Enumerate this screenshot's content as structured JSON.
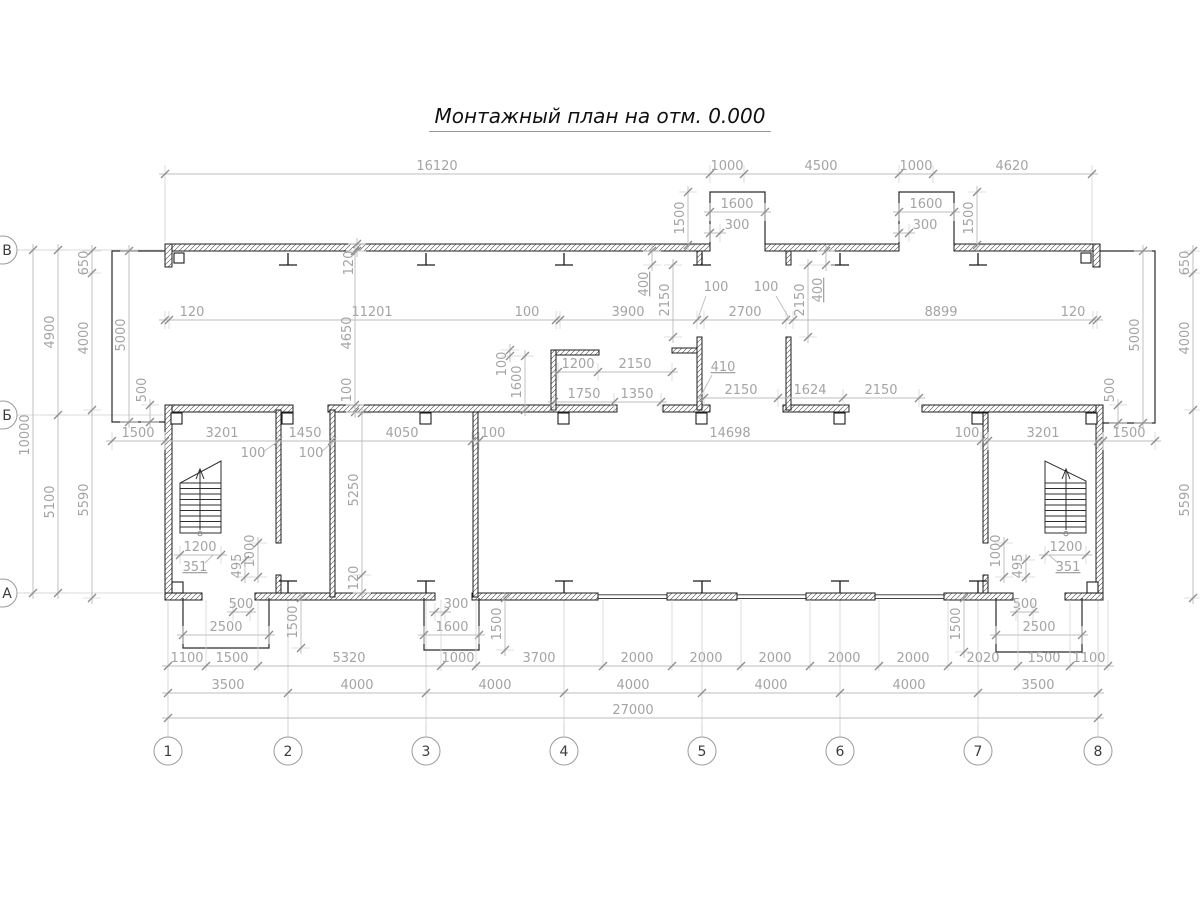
{
  "title": {
    "text": "Монтажный план на отм. 0.000"
  },
  "colors": {
    "wall": "#1c1c1c",
    "dim_line": "#bcbcbc",
    "dim_text": "#a4a4a4",
    "grid_line": "#cfcfcf",
    "bubble_stroke": "#9b9b9b"
  },
  "axis_bubbles": {
    "columns_y": 751,
    "radius": 14,
    "columns": [
      {
        "label": "1",
        "x": 168
      },
      {
        "label": "2",
        "x": 288
      },
      {
        "label": "3",
        "x": 426
      },
      {
        "label": "4",
        "x": 564
      },
      {
        "label": "5",
        "x": 702
      },
      {
        "label": "6",
        "x": 840
      },
      {
        "label": "7",
        "x": 978
      },
      {
        "label": "8",
        "x": 1098
      }
    ],
    "rows_x": 3,
    "rows": [
      {
        "label": "В",
        "y": 250
      },
      {
        "label": "Б",
        "y": 415
      },
      {
        "label": "А",
        "y": 593
      }
    ]
  },
  "dimensions": [
    {
      "dir": "h",
      "at": 174,
      "ticks": [
        165,
        710,
        744,
        899,
        933,
        1092
      ],
      "labels": [
        {
          "t": "16120",
          "c": 437
        },
        {
          "t": "1000",
          "c": 727
        },
        {
          "t": "4500",
          "c": 821
        },
        {
          "t": "1000",
          "c": 916
        },
        {
          "t": "4620",
          "c": 1012
        }
      ]
    },
    {
      "dir": "h",
      "at": 212,
      "ticks": [
        710,
        765
      ],
      "labels": [
        {
          "t": "1600",
          "c": 737
        }
      ]
    },
    {
      "dir": "h",
      "at": 233,
      "ticks": [
        710,
        720
      ],
      "labels": [
        {
          "t": "300",
          "c": 737
        }
      ]
    },
    {
      "dir": "h",
      "at": 212,
      "ticks": [
        899,
        954
      ],
      "labels": [
        {
          "t": "1600",
          "c": 926
        }
      ]
    },
    {
      "dir": "h",
      "at": 233,
      "ticks": [
        899,
        909
      ],
      "labels": [
        {
          "t": "300",
          "c": 925
        }
      ]
    },
    {
      "dir": "h",
      "at": 320,
      "ticks": [
        165,
        169,
        556,
        560,
        697,
        704,
        786,
        793,
        1093,
        1097
      ],
      "labels": [
        {
          "t": "120",
          "c": 192
        },
        {
          "t": "11201",
          "c": 372
        },
        {
          "t": "100",
          "c": 527
        },
        {
          "t": "3900",
          "c": 628
        },
        {
          "t": "2700",
          "c": 745
        },
        {
          "t": "8899",
          "c": 941
        },
        {
          "t": "120",
          "c": 1073
        }
      ]
    },
    {
      "dir": "h",
      "at": 441,
      "ticks": [
        112,
        165,
        278,
        332,
        472,
        479,
        981,
        988,
        1098,
        1103,
        1155
      ],
      "labels": [
        {
          "t": "1500",
          "c": 138
        },
        {
          "t": "3201",
          "c": 222
        },
        {
          "t": "1450",
          "c": 305
        },
        {
          "t": "4050",
          "c": 402
        },
        {
          "t": "100",
          "c": 493
        },
        {
          "t": "14698",
          "c": 730
        },
        {
          "t": "100",
          "c": 967
        },
        {
          "t": "3201",
          "c": 1043
        },
        {
          "t": "1500",
          "c": 1129
        }
      ]
    },
    {
      "dir": "h",
      "at": 372,
      "ticks": [
        558,
        598,
        672
      ],
      "labels": [
        {
          "t": "1200",
          "c": 578
        },
        {
          "t": "2150",
          "c": 635
        }
      ]
    },
    {
      "dir": "h",
      "at": 402,
      "ticks": [
        554,
        614,
        661
      ],
      "labels": [
        {
          "t": "1750",
          "c": 584
        },
        {
          "t": "1350",
          "c": 637
        }
      ]
    },
    {
      "dir": "h",
      "at": 398,
      "ticks": [
        704,
        778,
        843,
        919
      ],
      "labels": [
        {
          "t": "2150",
          "c": 741
        },
        {
          "t": "1624",
          "c": 810
        },
        {
          "t": "2150",
          "c": 881
        }
      ]
    },
    {
      "dir": "h",
      "at": 555,
      "ticks": [
        180,
        221
      ],
      "labels": [
        {
          "t": "1200",
          "c": 200
        }
      ]
    },
    {
      "dir": "h",
      "at": 555,
      "ticks": [
        1045,
        1086
      ],
      "labels": [
        {
          "t": "1200",
          "c": 1066
        }
      ]
    },
    {
      "dir": "h",
      "at": 612,
      "ticks": [
        233,
        250
      ],
      "labels": [
        {
          "t": "500",
          "c": 241
        }
      ]
    },
    {
      "dir": "h",
      "at": 635,
      "ticks": [
        183,
        269
      ],
      "labels": [
        {
          "t": "2500",
          "c": 226
        }
      ]
    },
    {
      "dir": "h",
      "at": 612,
      "ticks": [
        435,
        445
      ],
      "labels": [
        {
          "t": "300",
          "c": 456
        }
      ]
    },
    {
      "dir": "h",
      "at": 635,
      "ticks": [
        424,
        479
      ],
      "labels": [
        {
          "t": "1600",
          "c": 452
        }
      ]
    },
    {
      "dir": "h",
      "at": 612,
      "ticks": [
        1016,
        1033
      ],
      "labels": [
        {
          "t": "500",
          "c": 1025
        }
      ]
    },
    {
      "dir": "h",
      "at": 635,
      "ticks": [
        996,
        1082
      ],
      "labels": [
        {
          "t": "2500",
          "c": 1039
        }
      ]
    },
    {
      "dir": "h",
      "at": 666,
      "eu": 66,
      "ed": 5,
      "ticks": [
        168,
        206,
        258,
        441,
        476,
        603,
        672,
        741,
        810,
        879,
        948,
        1018,
        1070,
        1108
      ],
      "labels": [
        {
          "t": "1100",
          "c": 187
        },
        {
          "t": "1500",
          "c": 232
        },
        {
          "t": "5320",
          "c": 349
        },
        {
          "t": "1000",
          "c": 458
        },
        {
          "t": "3700",
          "c": 539
        },
        {
          "t": "2000",
          "c": 637
        },
        {
          "t": "2000",
          "c": 706
        },
        {
          "t": "2000",
          "c": 775
        },
        {
          "t": "2000",
          "c": 844
        },
        {
          "t": "2000",
          "c": 913
        },
        {
          "t": "2020",
          "c": 983
        },
        {
          "t": "1500",
          "c": 1044
        },
        {
          "t": "1100",
          "c": 1089
        }
      ]
    },
    {
      "dir": "h",
      "at": 693,
      "ticks": [
        168,
        288,
        426,
        564,
        702,
        840,
        978,
        1098
      ],
      "labels": [
        {
          "t": "3500",
          "c": 228
        },
        {
          "t": "4000",
          "c": 357
        },
        {
          "t": "4000",
          "c": 495
        },
        {
          "t": "4000",
          "c": 633
        },
        {
          "t": "4000",
          "c": 771
        },
        {
          "t": "4000",
          "c": 909
        },
        {
          "t": "3500",
          "c": 1038
        }
      ]
    },
    {
      "dir": "h",
      "at": 718,
      "ticks": [
        168,
        1098
      ],
      "labels": [
        {
          "t": "27000",
          "c": 633
        }
      ]
    },
    {
      "dir": "v",
      "at": 688,
      "ticks": [
        192,
        245
      ],
      "labels": [
        {
          "t": "1500",
          "c": 218
        }
      ]
    },
    {
      "dir": "v",
      "at": 977,
      "ticks": [
        192,
        245
      ],
      "labels": [
        {
          "t": "1500",
          "c": 218
        }
      ]
    },
    {
      "dir": "v",
      "at": 33,
      "ticks": [
        250,
        593
      ],
      "labels": [
        {
          "t": "10000",
          "c": 435
        }
      ]
    },
    {
      "dir": "v",
      "at": 58,
      "ticks": [
        250,
        415,
        593
      ],
      "labels": [
        {
          "t": "4900",
          "c": 332
        },
        {
          "t": "5100",
          "c": 502
        }
      ]
    },
    {
      "dir": "v",
      "at": 92,
      "ticks": [
        251,
        273,
        410,
        598
      ],
      "labels": [
        {
          "t": "650",
          "c": 263
        },
        {
          "t": "4000",
          "c": 338
        },
        {
          "t": "5590",
          "c": 500
        }
      ]
    },
    {
      "dir": "v",
      "at": 129,
      "ticks": [
        251,
        422
      ],
      "labels": [
        {
          "t": "5000",
          "c": 335
        }
      ]
    },
    {
      "dir": "v",
      "at": 150,
      "ticks": [
        405,
        422
      ],
      "labels": [
        {
          "t": "500",
          "c": 390
        }
      ]
    },
    {
      "dir": "v",
      "at": 357,
      "ticks": [
        244,
        251
      ],
      "labels": [
        {
          "t": "120",
          "c": 263
        }
      ]
    },
    {
      "dir": "v",
      "at": 355,
      "ticks": [
        251,
        405,
        412
      ],
      "labels": [
        {
          "t": "4650",
          "c": 333
        },
        {
          "t": "100",
          "c": 390
        }
      ]
    },
    {
      "dir": "v",
      "at": 510,
      "ticks": [
        350,
        356
      ],
      "labels": [
        {
          "t": "100",
          "c": 364
        }
      ]
    },
    {
      "dir": "v",
      "at": 525,
      "ticks": [
        356,
        410
      ],
      "labels": [
        {
          "t": "1600",
          "c": 382
        }
      ]
    },
    {
      "dir": "v",
      "at": 673,
      "ticks": [
        265,
        337
      ],
      "labels": [
        {
          "t": "2150",
          "c": 300
        }
      ]
    },
    {
      "dir": "v",
      "at": 808,
      "ticks": [
        265,
        337
      ],
      "labels": [
        {
          "t": "2150",
          "c": 300
        }
      ]
    },
    {
      "dir": "v",
      "at": 652,
      "ticks": [
        251,
        265
      ],
      "labels": [
        {
          "t": "400",
          "c": 284,
          "u": 1
        }
      ]
    },
    {
      "dir": "v",
      "at": 826,
      "ticks": [
        251,
        265
      ],
      "labels": [
        {
          "t": "400",
          "c": 290,
          "u": 1
        }
      ]
    },
    {
      "dir": "v",
      "at": 362,
      "ticks": [
        413,
        575,
        593
      ],
      "labels": [
        {
          "t": "5250",
          "c": 490
        },
        {
          "t": "120",
          "c": 578
        }
      ]
    },
    {
      "dir": "v",
      "at": 301,
      "ticks": [
        598,
        648
      ],
      "labels": [
        {
          "t": "1500",
          "c": 622
        }
      ]
    },
    {
      "dir": "v",
      "at": 505,
      "ticks": [
        598,
        650
      ],
      "labels": [
        {
          "t": "1500",
          "c": 624
        }
      ]
    },
    {
      "dir": "v",
      "at": 964,
      "ticks": [
        598,
        652
      ],
      "labels": [
        {
          "t": "1500",
          "c": 624
        }
      ]
    },
    {
      "dir": "v",
      "at": 258,
      "ticks": [
        543,
        577
      ],
      "labels": [
        {
          "t": "1000",
          "c": 551
        }
      ]
    },
    {
      "dir": "v",
      "at": 245,
      "ticks": [
        560,
        577
      ],
      "labels": [
        {
          "t": "495",
          "c": 566
        }
      ]
    },
    {
      "dir": "v",
      "at": 1004,
      "ticks": [
        543,
        577
      ],
      "labels": [
        {
          "t": "1000",
          "c": 551
        }
      ]
    },
    {
      "dir": "v",
      "at": 1026,
      "ticks": [
        560,
        577
      ],
      "labels": [
        {
          "t": "495",
          "c": 566
        }
      ]
    },
    {
      "dir": "v",
      "at": 1143,
      "ticks": [
        251,
        423
      ],
      "labels": [
        {
          "t": "5000",
          "c": 335
        }
      ]
    },
    {
      "dir": "v",
      "at": 1118,
      "ticks": [
        405,
        423
      ],
      "labels": [
        {
          "t": "500",
          "c": 390
        }
      ]
    },
    {
      "dir": "v",
      "at": 1193,
      "ticks": [
        251,
        273,
        410,
        598
      ],
      "labels": [
        {
          "t": "650",
          "c": 263
        },
        {
          "t": "4000",
          "c": 338
        },
        {
          "t": "5590",
          "c": 500
        }
      ]
    }
  ],
  "leaders": [
    {
      "t": "100",
      "x": 716,
      "y": 291,
      "pts": [
        [
          706,
          296
        ],
        [
          698,
          318
        ]
      ]
    },
    {
      "t": "100",
      "x": 766,
      "y": 291,
      "pts": [
        [
          776,
          296
        ],
        [
          789,
          318
        ]
      ]
    },
    {
      "t": "410",
      "x": 723,
      "y": 371,
      "u": 1,
      "pts": [
        [
          712,
          375
        ],
        [
          699,
          399
        ]
      ]
    },
    {
      "t": "100",
      "x": 253,
      "y": 457,
      "pts": [
        [
          263,
          452
        ],
        [
          277,
          442
        ]
      ]
    },
    {
      "t": "100",
      "x": 311,
      "y": 457,
      "pts": [
        [
          321,
          452
        ],
        [
          333,
          442
        ]
      ]
    },
    {
      "t": "351",
      "x": 195,
      "y": 571,
      "u": 1,
      "pts": [
        [
          205,
          563
        ],
        [
          213,
          555
        ]
      ]
    },
    {
      "t": "351",
      "x": 1068,
      "y": 571,
      "u": 1,
      "pts": [
        [
          1058,
          563
        ],
        [
          1049,
          555
        ]
      ]
    }
  ]
}
